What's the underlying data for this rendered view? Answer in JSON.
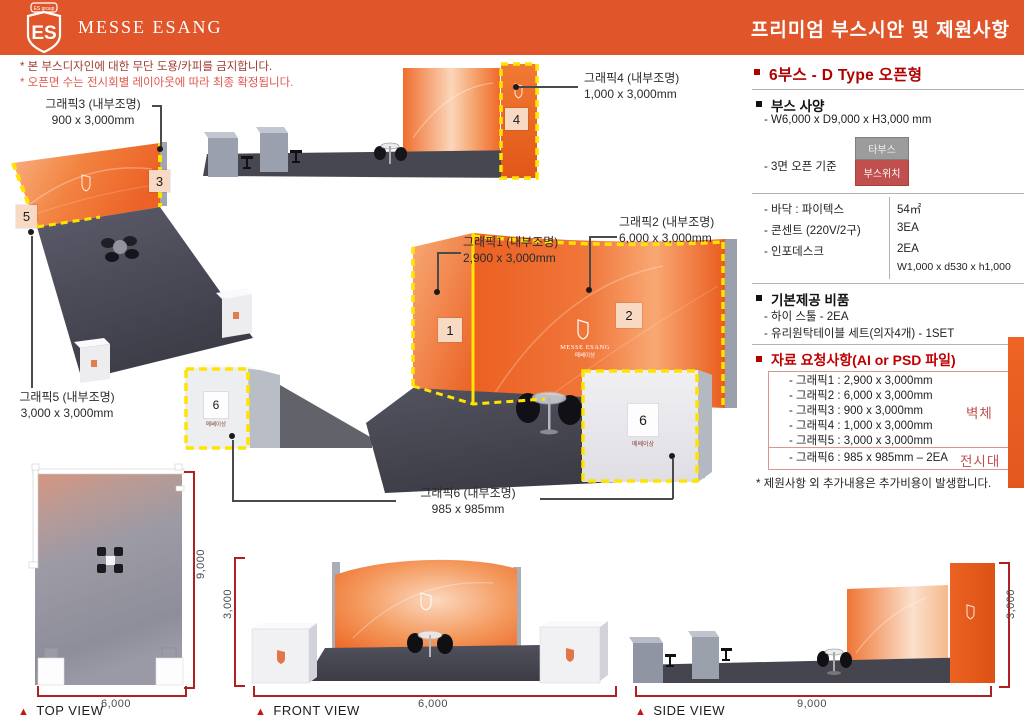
{
  "header": {
    "logo_banner": "ES group",
    "logo_letters": "ES",
    "brand": "MESSE ESANG",
    "title": "프리미엄 부스시안 및 제원사항"
  },
  "notes": {
    "line1": "* 본 부스디자인에 대한 무단 도용/카피를 금지합니다.",
    "line2": "* 오픈면 수는 전시회별 레이아웃에 따라 최종 확정됩니다."
  },
  "graphics": {
    "g1": {
      "title": "그래픽1 (내부조명)",
      "size": "2,900 x 3,000mm"
    },
    "g2": {
      "title": "그래픽2 (내부조명)",
      "size": "6,000 x 3,000mm"
    },
    "g3": {
      "title": "그래픽3 (내부조명)",
      "size": "900 x 3,000mm"
    },
    "g4": {
      "title": "그래픽4 (내부조명)",
      "size": "1,000 x 3,000mm"
    },
    "g5": {
      "title": "그래픽5 (내부조명)",
      "size": "3,000 x 3,000mm"
    },
    "g6": {
      "title": "그래픽6 (내부조명)",
      "size": "985 x 985mm"
    }
  },
  "badges": {
    "b1": "1",
    "b2": "2",
    "b3": "3",
    "b4": "4",
    "b5": "5",
    "b6": "6"
  },
  "booth": {
    "wall_logo_brand": "MESSE ESANG",
    "wall_logo_sub": "메쎄이상",
    "cube_caption": "메쎄이상"
  },
  "views": {
    "marker": "▲",
    "top": {
      "label": "TOP VIEW",
      "width": "6,000",
      "depth": "9,000"
    },
    "front": {
      "label": "FRONT VIEW",
      "width": "6,000",
      "height": "3,000"
    },
    "side": {
      "label": "SIDE VIEW",
      "width": "9,000",
      "height": "3,000"
    }
  },
  "spec": {
    "title": "6부스 - D Type 오픈형",
    "booth_heading": "부스 사양",
    "booth_dims": "- W6,000 x D9,000 x H3,000 mm",
    "open_basis": "- 3면 오픈 기준",
    "minimap": {
      "other_booth": "타부스",
      "booth_pos": "부스위치"
    },
    "detail_rows": [
      {
        "item": "- 바닥 : 파이텍스",
        "value": "54㎡"
      },
      {
        "item": "- 콘센트 (220V/2구)",
        "value": "3EA"
      },
      {
        "item": "- 인포데스크",
        "value": "2EA"
      },
      {
        "item": "",
        "value": "W1,000 x d530 x h1,000"
      }
    ],
    "included_heading": "기본제공 비품",
    "included": [
      "- 하이 스툴 - 2EA",
      "- 유리원탁테이블 세트(의자4개) - 1SET"
    ],
    "request_heading": "자료 요청사항(AI or PSD 파일)",
    "request_items": [
      "- 그래픽1 : 2,900 x 3,000mm",
      "- 그래픽2 : 6,000 x 3,000mm",
      "- 그래픽3 : 900 x 3,000mm",
      "- 그래픽4 : 1,000 x 3,000mm",
      "- 그래픽5 : 3,000 x 3,000mm"
    ],
    "request_item_stand": "- 그래픽6 : 985 x 985mm – 2EA",
    "tag_wall": "벽체",
    "tag_stand": "전시대",
    "footnote": "* 제원사항 외 추가내용은 추가비용이 발생합니다."
  },
  "colors": {
    "header_orange": "#E0562A",
    "accent_red": "#C00000",
    "muted_red": "#C0504D",
    "highlight_yellow": "#FFE400",
    "dim_red": "#B02020"
  }
}
